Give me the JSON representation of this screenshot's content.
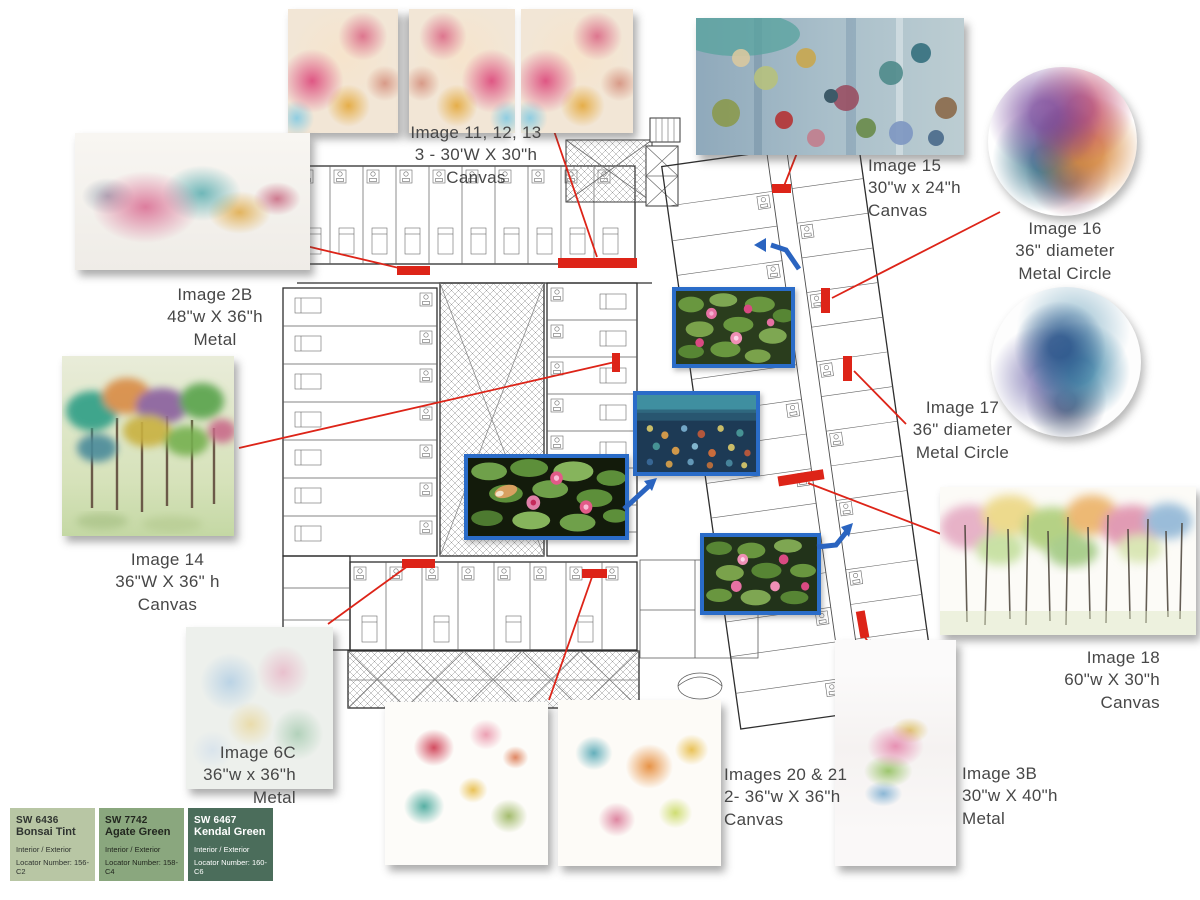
{
  "artworks": [
    {
      "id": "images-11-12-13",
      "title": "Image 11, 12, 13",
      "size": "3 - 30'W X 30\"h",
      "medium": "Canvas"
    },
    {
      "id": "image-2b",
      "title": "Image 2B",
      "size": "48\"w X 36\"h",
      "medium": "Metal"
    },
    {
      "id": "image-15",
      "title": "Image 15",
      "size": "30\"w x 24\"h",
      "medium": "Canvas"
    },
    {
      "id": "image-16",
      "title": "Image 16",
      "size": "36\" diameter",
      "medium": "Metal Circle"
    },
    {
      "id": "image-17",
      "title": "Image 17",
      "size": "36\" diameter",
      "medium": "Metal Circle"
    },
    {
      "id": "image-14",
      "title": "Image 14",
      "size": "36\"W X 36\" h",
      "medium": "Canvas"
    },
    {
      "id": "image-18",
      "title": "Image 18",
      "size": "60\"w X 30\"h",
      "medium": "Canvas"
    },
    {
      "id": "image-6c",
      "title": "Image 6C",
      "size": "36\"w x 36\"h",
      "medium": "Metal"
    },
    {
      "id": "images-20-21",
      "title": "Images 20 & 21",
      "size": "2- 36\"w X 36\"h",
      "medium": "Canvas"
    },
    {
      "id": "image-3b",
      "title": "Image 3B",
      "size": "30\"w X 40\"h",
      "medium": "Metal"
    }
  ],
  "swatches": [
    {
      "code": "SW 6436",
      "name": "Bonsai Tint",
      "usage": "Interior / Exterior",
      "locator": "Locator Number: 156-C2",
      "hex": "#b8c6a4",
      "text_color": "#2f3430"
    },
    {
      "code": "SW 7742",
      "name": "Agate Green",
      "usage": "Interior / Exterior",
      "locator": "Locator Number: 158-C4",
      "hex": "#8aa77e",
      "text_color": "#22271f"
    },
    {
      "code": "SW 6467",
      "name": "Kendal Green",
      "usage": "Interior / Exterior",
      "locator": "Locator Number: 160-C6",
      "hex": "#4b6d5b",
      "text_color": "#ffffff"
    }
  ],
  "plan_photos": [
    {
      "name": "water-lilies-pink-photo-1"
    },
    {
      "name": "water-lilies-impressionist-painting"
    },
    {
      "name": "water-lilies-koi-pond-photo"
    },
    {
      "name": "water-lilies-pink-photo-2"
    }
  ],
  "colors": {
    "marker_red": "#dd2418",
    "arrow_blue": "#2a64c0",
    "photo_border_blue": "#2a6cc8",
    "label_text": "#474747",
    "plan_line": "#4d4d4d"
  }
}
